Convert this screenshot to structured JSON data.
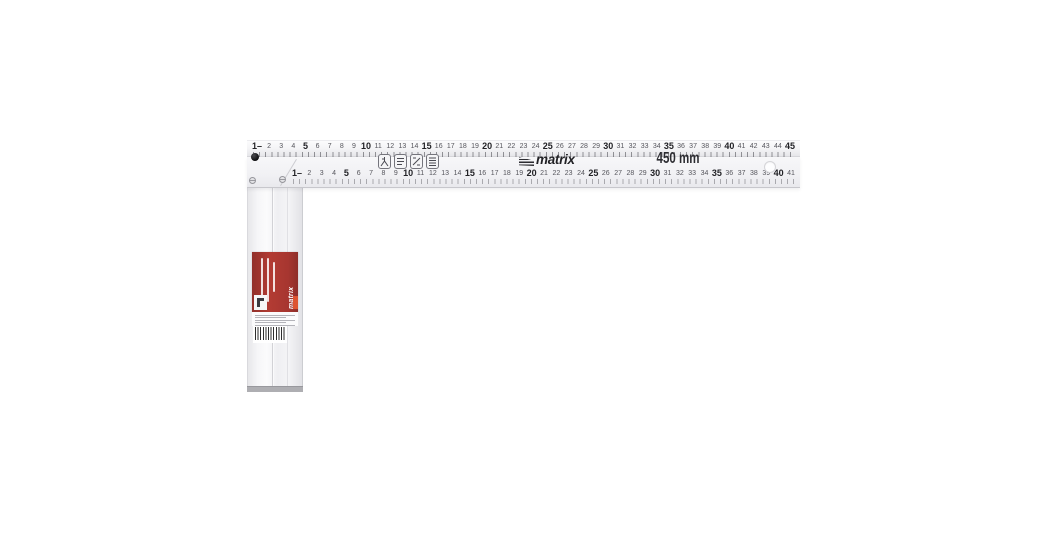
{
  "product": {
    "brand": "matrix",
    "length_label": "450 mm"
  },
  "blade": {
    "outer_scale": {
      "unit": "cm",
      "bold_multiple": 5,
      "labels": [
        "1–",
        "2",
        "3",
        "4",
        "5",
        "6",
        "7",
        "8",
        "9",
        "10",
        "11",
        "12",
        "13",
        "14",
        "15",
        "16",
        "17",
        "18",
        "19",
        "20",
        "21",
        "22",
        "23",
        "24",
        "25",
        "26",
        "27",
        "28",
        "29",
        "30",
        "31",
        "32",
        "33",
        "34",
        "35",
        "36",
        "37",
        "38",
        "39",
        "40",
        "41",
        "42",
        "43",
        "44",
        "45"
      ]
    },
    "inner_scale": {
      "unit": "cm",
      "bold_multiple": 5,
      "labels": [
        "1–",
        "2",
        "3",
        "4",
        "5",
        "6",
        "7",
        "8",
        "9",
        "10",
        "11",
        "12",
        "13",
        "14",
        "15",
        "16",
        "17",
        "18",
        "19",
        "20",
        "21",
        "22",
        "23",
        "24",
        "25",
        "26",
        "27",
        "28",
        "29",
        "30",
        "31",
        "32",
        "33",
        "34",
        "35",
        "36",
        "37",
        "38",
        "39",
        "40",
        "41"
      ]
    },
    "pictograms": [
      "angle-use-pictogram",
      "spec-lines-pictogram",
      "marking-pictogram",
      "table-lines-pictogram"
    ]
  },
  "label": {
    "brand": "matrix",
    "accent_color": "#b23b33",
    "accent_strip_color": "#dd5330",
    "has_barcode": true
  },
  "colors": {
    "background": "#ffffff",
    "metal_light": "#f6f6f8",
    "metal_edge": "#c7c7cc",
    "print_dark": "#2c2c31"
  }
}
